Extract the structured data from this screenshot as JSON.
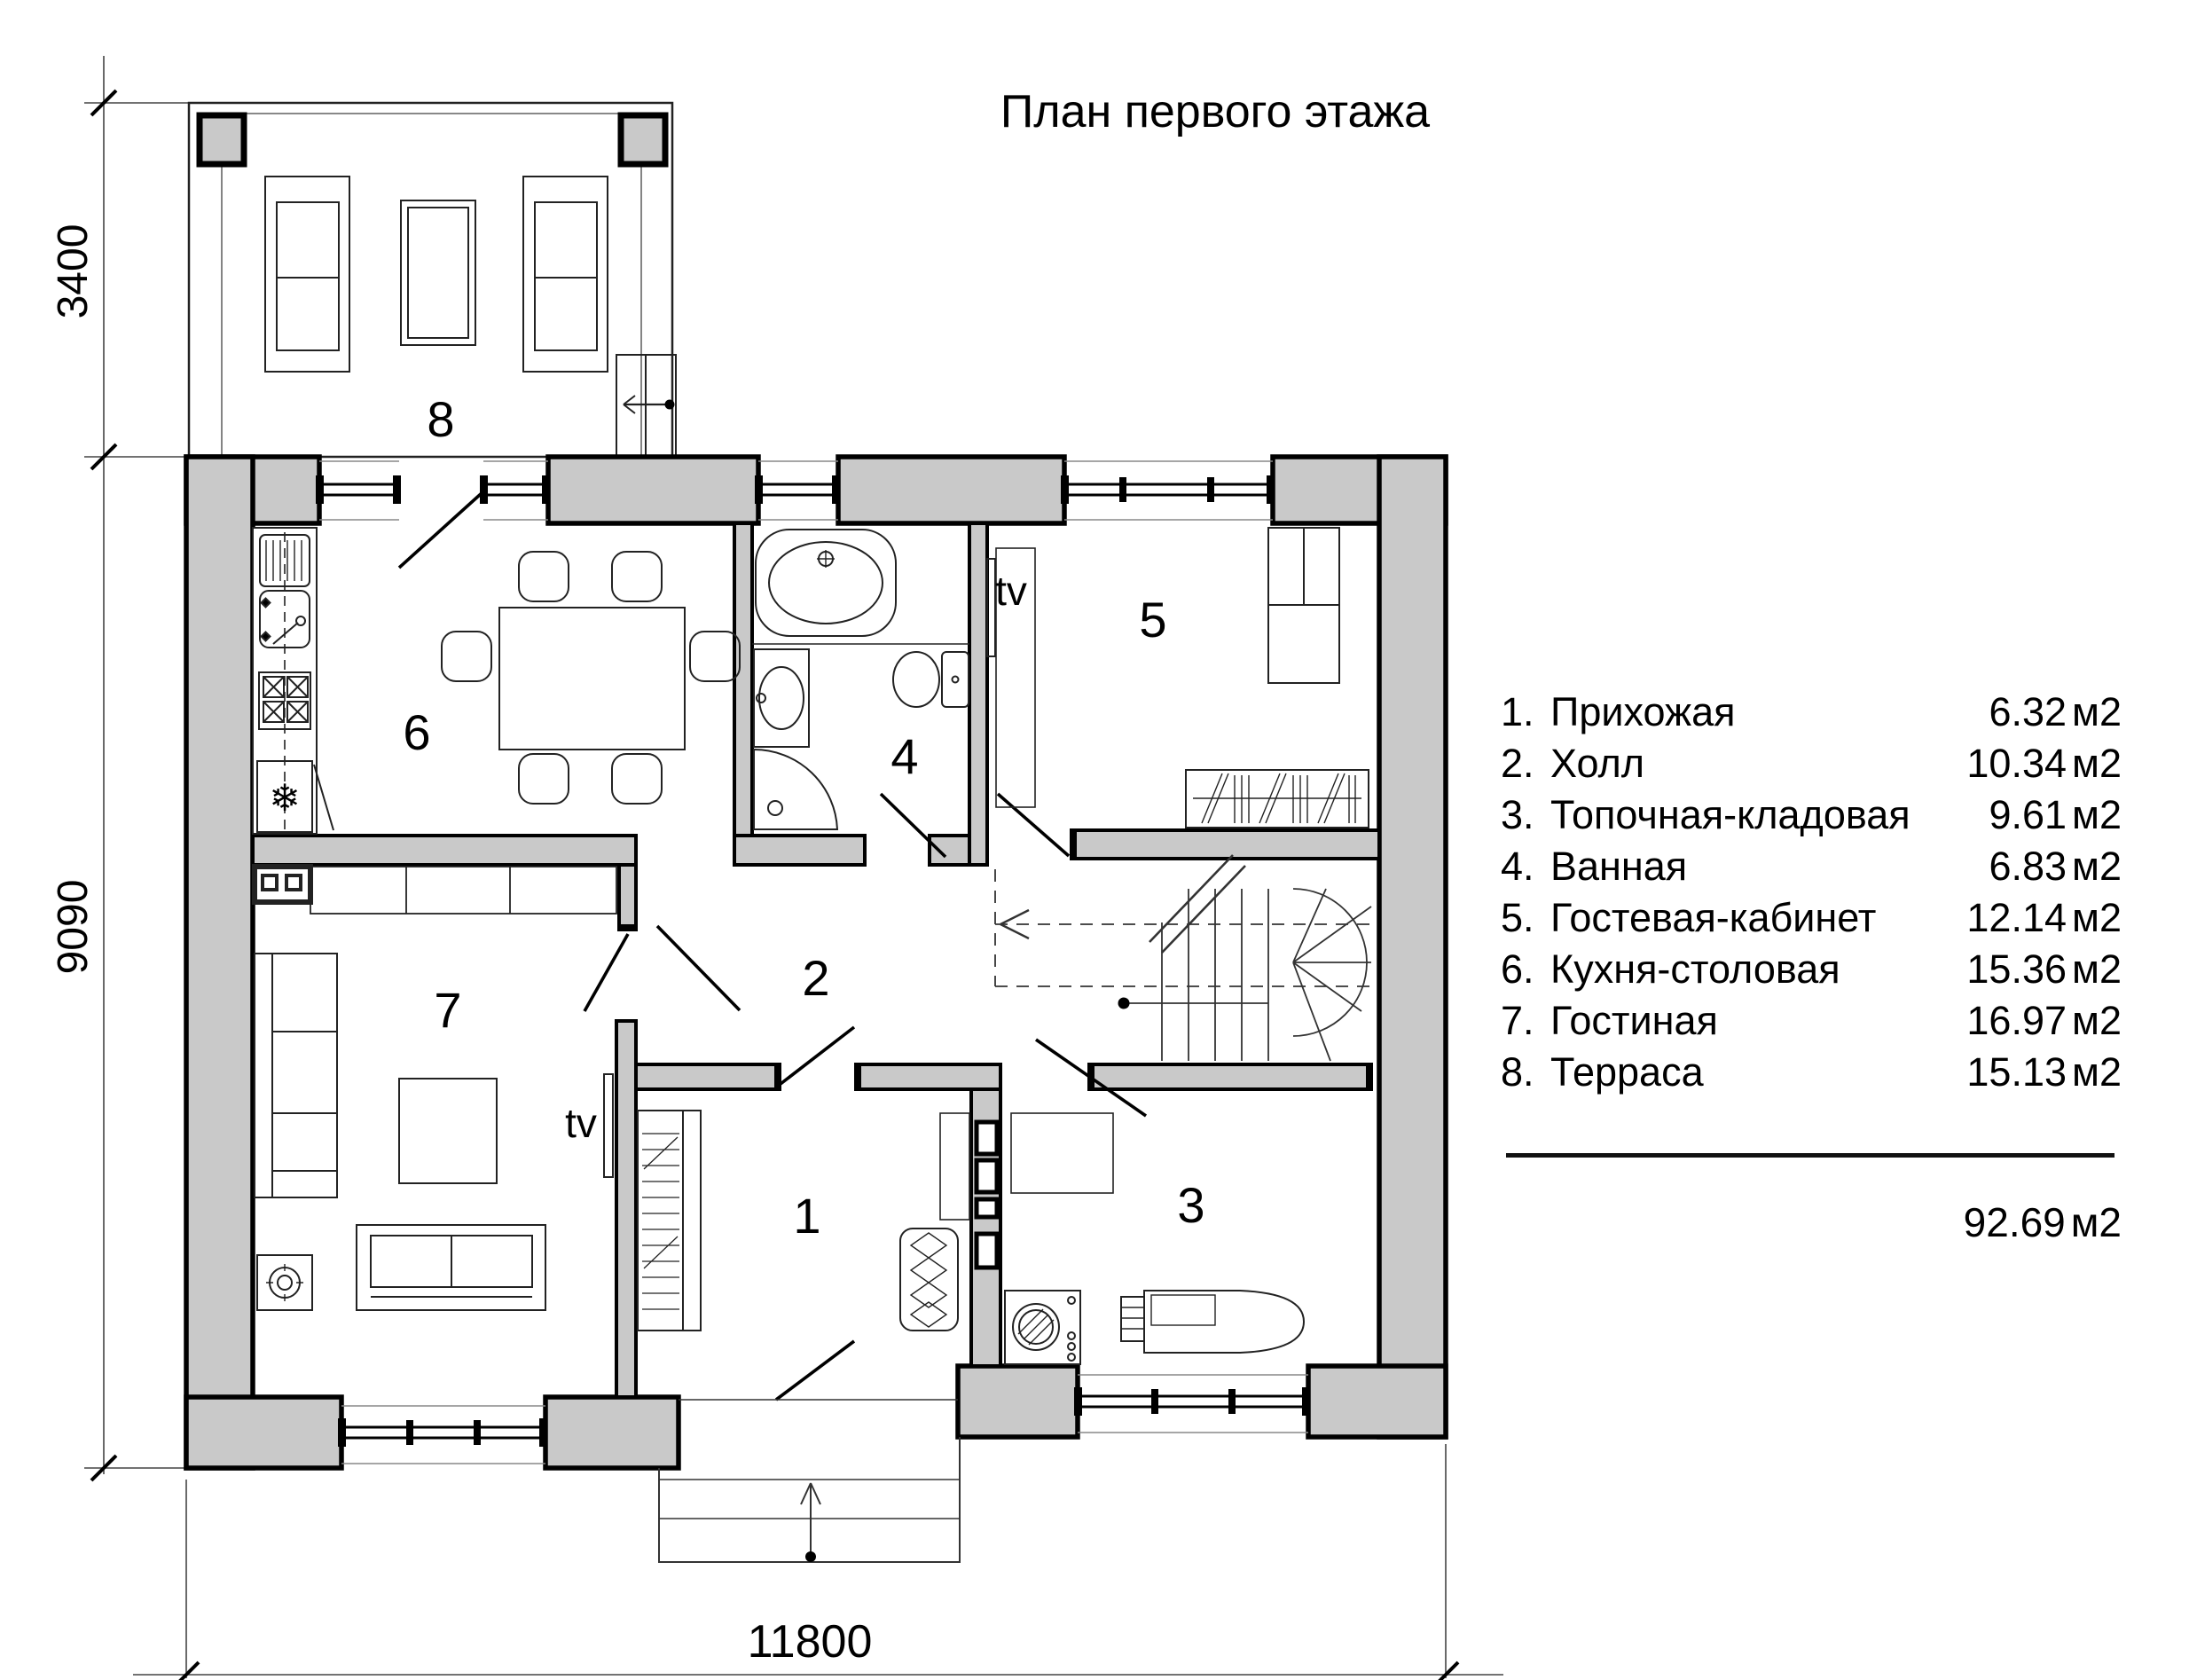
{
  "title": "План первого этажа",
  "plan": {
    "room_numbers": [
      "1",
      "2",
      "3",
      "4",
      "5",
      "6",
      "7",
      "8"
    ],
    "tv": "tv",
    "dims": {
      "terrace_depth": "3400",
      "house_depth": "9090",
      "house_width": "11800"
    }
  },
  "legend": {
    "items": [
      {
        "num": "1.",
        "name": "Прихожая",
        "area": "6.32",
        "unit": "м2"
      },
      {
        "num": "2.",
        "name": "Холл",
        "area": "10.34",
        "unit": "м2"
      },
      {
        "num": "3.",
        "name": "Топочная-кладовая",
        "area": "9.61",
        "unit": "м2"
      },
      {
        "num": "4.",
        "name": "Ванная",
        "area": "6.83",
        "unit": "м2"
      },
      {
        "num": "5.",
        "name": "Гостевая-кабинет",
        "area": "12.14",
        "unit": "м2"
      },
      {
        "num": "6.",
        "name": "Кухня-столовая",
        "area": "15.36",
        "unit": "м2"
      },
      {
        "num": "7.",
        "name": "Гостиная",
        "area": "16.97",
        "unit": "м2"
      },
      {
        "num": "8.",
        "name": "Терраса",
        "area": "15.13",
        "unit": "м2"
      }
    ],
    "total": "92.69",
    "total_unit": "м2"
  }
}
